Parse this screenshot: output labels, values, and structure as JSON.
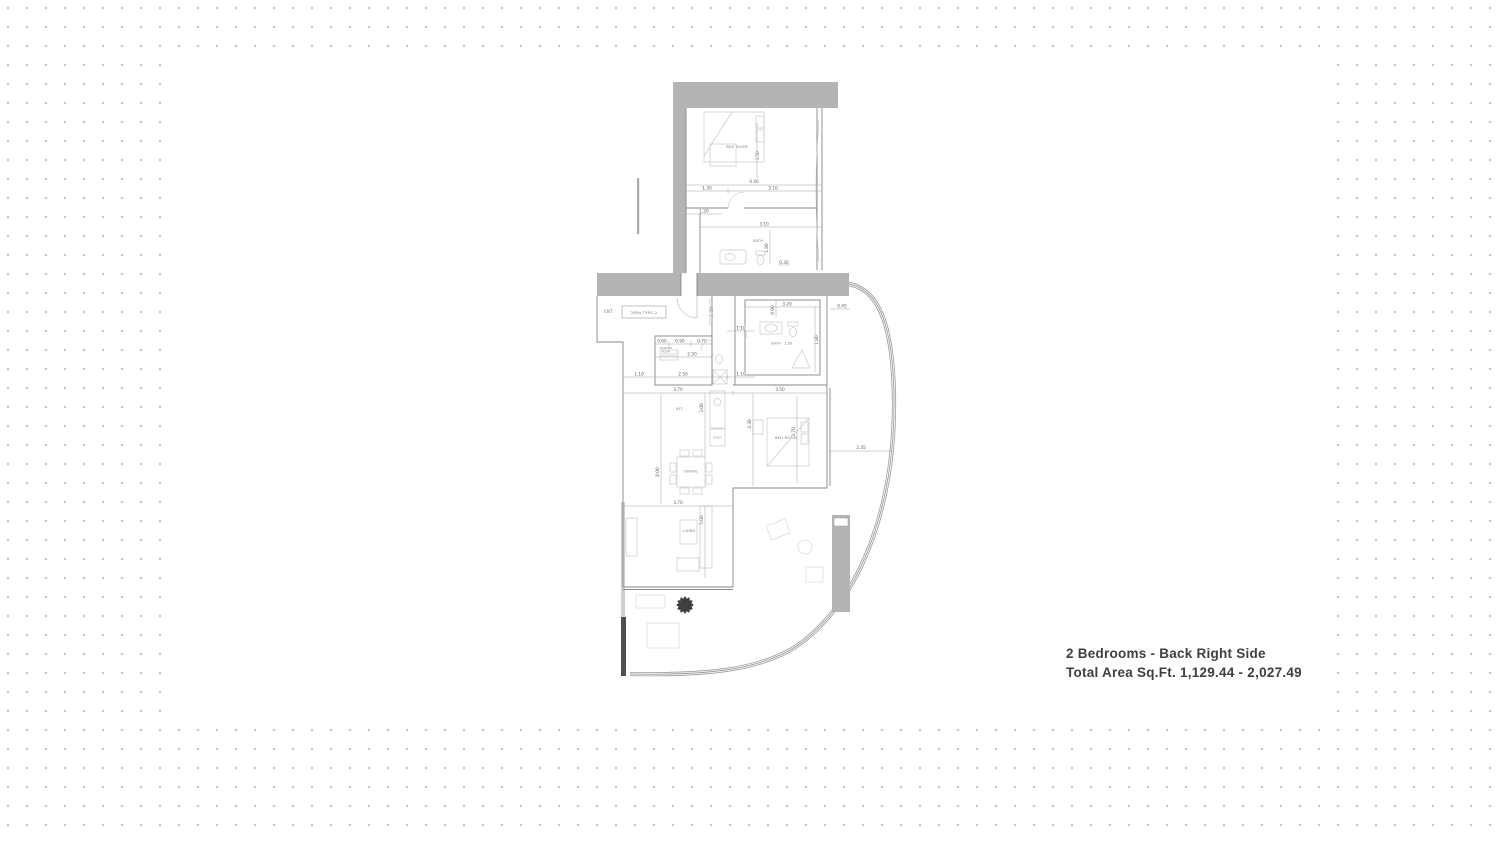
{
  "title_block": {
    "line1": "2 Bedrooms - Back Right Side",
    "line2": "Total Area Sq.Ft. 1,129.44 - 2,027.49"
  },
  "plan": {
    "unit_type": "2BRs TYPE-2",
    "rooms": {
      "bedroom1": "BED ROOM",
      "bath1": "BATH",
      "entry": "ENT.",
      "powder_l1": "POWDER",
      "powder_l2": "ROOM",
      "bath2": "BATH",
      "kitchen": "KIT.",
      "fridge": "FRIDGE",
      "dining": "DINING",
      "bedroom2": "BED ROOM",
      "living": "LIVING"
    },
    "dims": {
      "d440": "4.40",
      "d130": "1.30",
      "d310a": "3.10",
      "d350v": "3.50",
      "d120a": "1.20",
      "d310b": "3.10",
      "d180a": "1.80",
      "d030": "0.30",
      "d320": "3.20",
      "d090v": "0.90",
      "d045": "0.45",
      "d120v": "1.20",
      "d110a": "1.10",
      "d180b": "1.80",
      "d150": "1.50",
      "d060": "0.60",
      "d090": "0.90",
      "d070": "0.70",
      "d250a": "2.50",
      "d110b": "1.10",
      "d250b": "2.50",
      "d110c": "1.10",
      "d370a": "3.70",
      "d350": "3.50",
      "d300v": "3.00",
      "d430v": "4.30",
      "d370v": "3.70",
      "d800v": "8.00",
      "d235": "2.35",
      "d370b": "3.70",
      "d500v": "5.00"
    }
  },
  "colors": {
    "wall": "#b4b4b4",
    "dark_wall": "#4f4f4f",
    "dot": "#c6c6c6",
    "title_text": "#3f3f3f",
    "plant": "#3f3f3f"
  }
}
